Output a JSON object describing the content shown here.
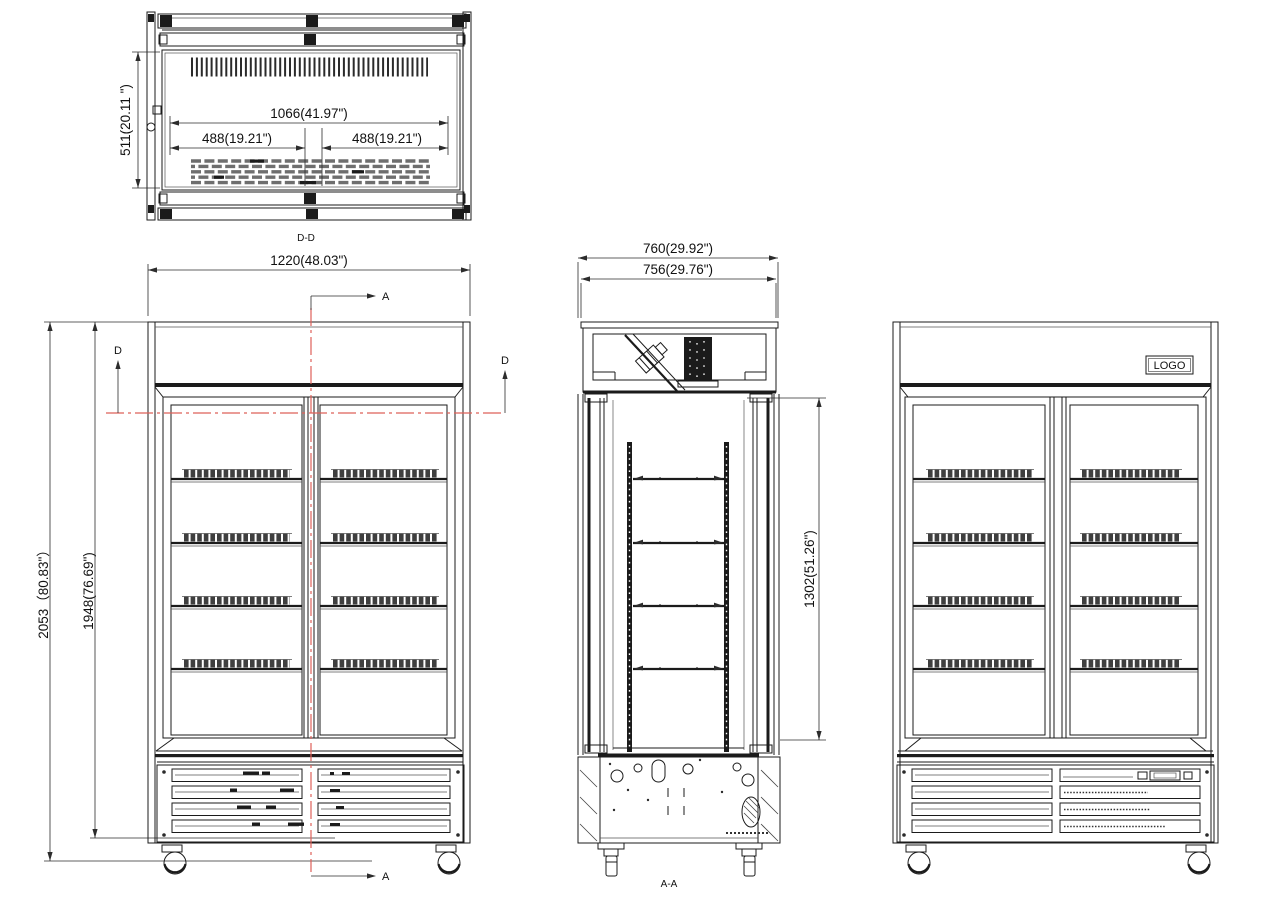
{
  "drawing": {
    "title": "double-door-merchandiser-technical-drawing",
    "colors": {
      "line": "#1b1b1b",
      "section_line": "#de6059"
    },
    "top_view": {
      "label": "D-D",
      "dim_inner_width": "1066(41.97\")",
      "dim_left_half": "488(19.21\")",
      "dim_right_half": "488(19.21\")",
      "dim_depth": "511(20.11 \")"
    },
    "front_view": {
      "dim_width": "1220(48.03\")",
      "dim_height_overall": "2053（80.83\"）",
      "dim_height_cabinet": "1948(76.69\")",
      "marker_a_top": "A",
      "marker_a_bottom": "A",
      "marker_d_left": "D",
      "marker_d_right": "D"
    },
    "section_view": {
      "label": "A-A",
      "dim_depth_overall": "760(29.92\")",
      "dim_depth_body": "756(29.76\")",
      "dim_interior_height": "1302(51.26\")"
    },
    "right_view": {
      "logo_label": "LOGO"
    }
  }
}
